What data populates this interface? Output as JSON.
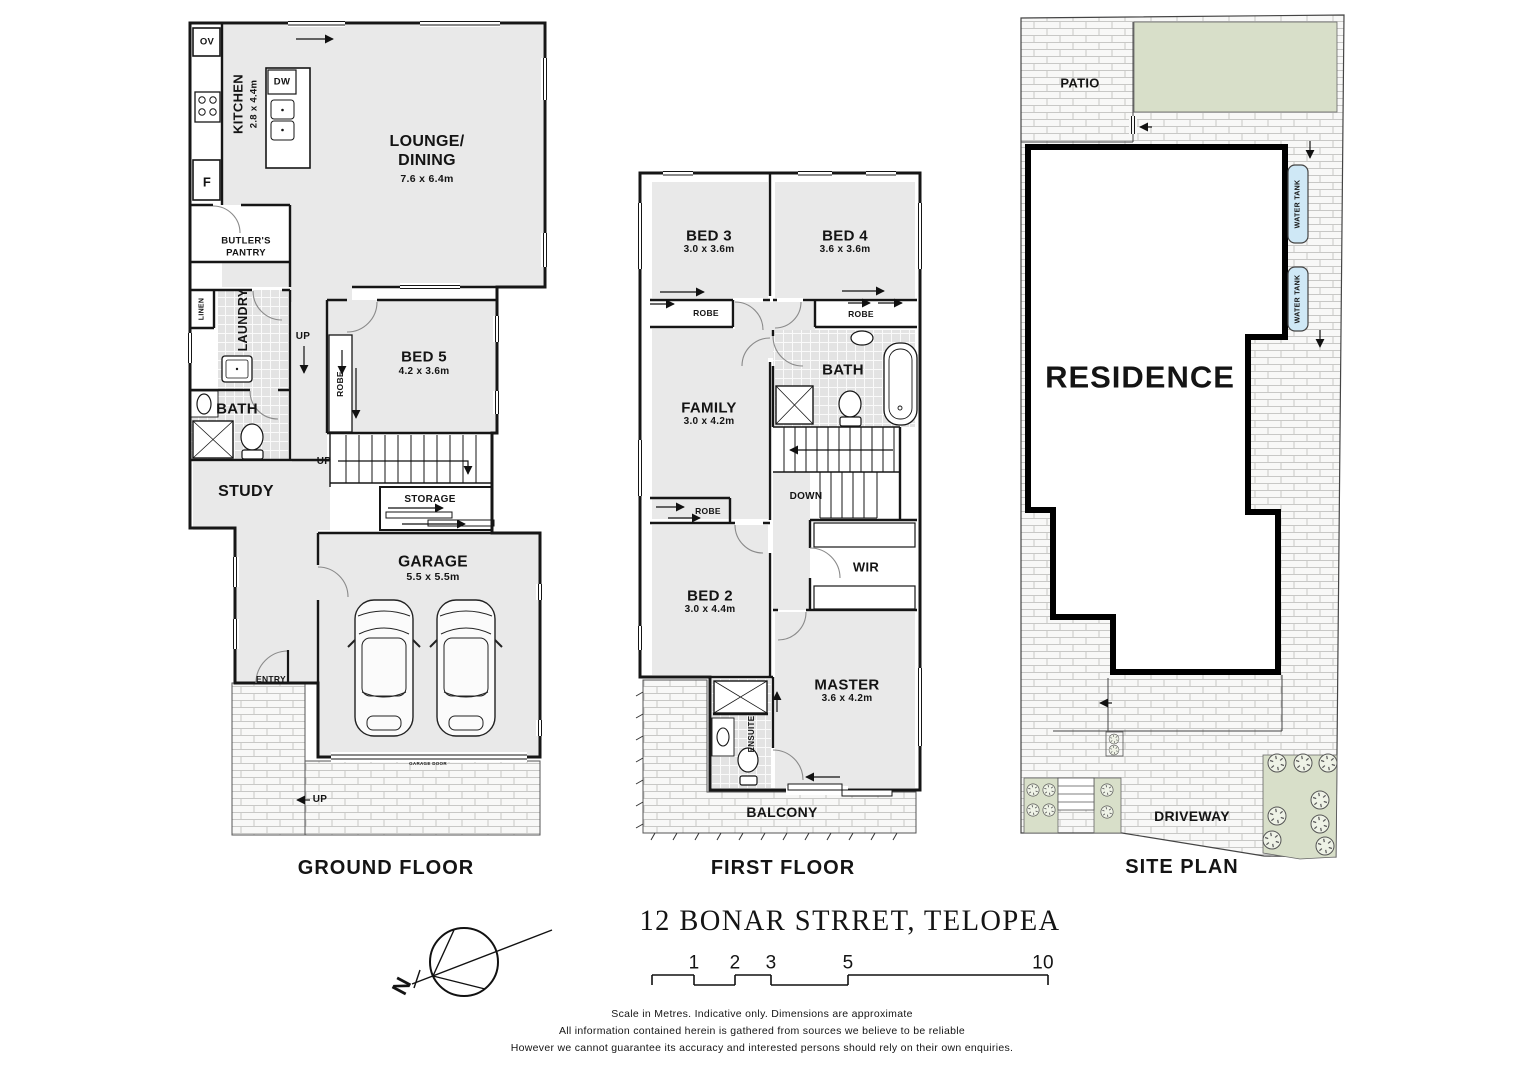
{
  "title": "12 BONAR STRRET, TELOPEA",
  "ground_floor": {
    "label": "GROUND FLOOR",
    "ov": "OV",
    "dw": "DW",
    "fridge": "F",
    "kitchen": "KITCHEN",
    "kitchen_dims": "2.8 x 4.4m",
    "lounge_line1": "LOUNGE/",
    "lounge_line2": "DINING",
    "lounge_dims": "7.6 x 6.4m",
    "butlers_line1": "BUTLER'S",
    "butlers_line2": "PANTRY",
    "linen": "LINEN",
    "laundry": "LAUNDRY",
    "up_hall": "UP",
    "bed5": "BED 5",
    "bed5_dims": "4.2 x 3.6m",
    "robe": "ROBE",
    "bath": "BATH",
    "up_stairs": "UP",
    "storage": "STORAGE",
    "study": "STUDY",
    "garage": "GARAGE",
    "garage_dims": "5.5 x 5.5m",
    "garage_door": "GARAGE DOOR",
    "entry": "ENTRY",
    "up_porch": "UP"
  },
  "first_floor": {
    "label": "FIRST FLOOR",
    "bed3": "BED 3",
    "bed3_dims": "3.0 x 3.6m",
    "bed4": "BED 4",
    "bed4_dims": "3.6 x 3.6m",
    "robe_bed3": "ROBE",
    "robe_bed4": "ROBE",
    "robe_bed2": "ROBE",
    "bath": "BATH",
    "family": "FAMILY",
    "family_dims": "3.0 x 4.2m",
    "down": "DOWN",
    "bed2": "BED 2",
    "bed2_dims": "3.0 x 4.4m",
    "wir": "WIR",
    "master": "MASTER",
    "master_dims": "3.6 x 4.2m",
    "ensuite": "ENSUITE",
    "balcony": "BALCONY"
  },
  "site_plan": {
    "label": "SITE PLAN",
    "patio": "PATIO",
    "residence": "RESIDENCE",
    "water_tank_1": "WATER TANK",
    "water_tank_2": "WATER TANK",
    "driveway": "DRIVEWAY"
  },
  "compass": {
    "north": "N"
  },
  "scale_bar": {
    "ticks": [
      "1",
      "2",
      "3",
      "5",
      "10"
    ]
  },
  "disclaimer": [
    "Scale in Metres. Indicative only. Dimensions are approximate",
    "All information contained herein is gathered from sources we believe to be reliable",
    "However we cannot guarantee its accuracy and interested persons should rely on their own enquiries."
  ],
  "colors": {
    "wall": "#161616",
    "room_fill": "#e9e9e9",
    "tile_fill": "#e3e3e3",
    "brick_line": "#c8c8c6",
    "lawn_green": "#d8dfc9",
    "water_tank_fill": "#cfe8f6"
  }
}
